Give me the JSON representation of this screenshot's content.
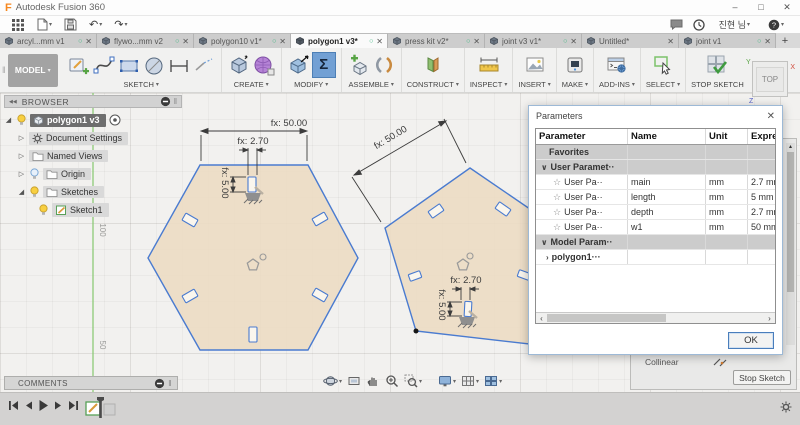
{
  "titlebar": {
    "app_title": "Autodesk Fusion 360"
  },
  "user": {
    "name": "진현 님"
  },
  "icons": {
    "dropdown": "▾",
    "minimize": "–",
    "maximize": "□",
    "window_close": "✕",
    "tab_status": "○",
    "tab_close": "✕",
    "new_tab": "+",
    "grip": "‖",
    "collapse_panel": "◀◀",
    "undo": "↶",
    "redo": "↷",
    "sigma": "Σ",
    "expand": "◢",
    "collapsed": "▷",
    "star": "☆",
    "chevron_down": "∨",
    "chevron_right": "›",
    "scroll_left": "‹",
    "scroll_right": "›",
    "scroll_up": "▴",
    "help": "?"
  },
  "tabs": {
    "items": [
      {
        "label": "arcyl...mm v1",
        "status": true,
        "active": false
      },
      {
        "label": "flywo...mm v2",
        "status": true,
        "active": false
      },
      {
        "label": "polygon10 v1*",
        "status": true,
        "active": false
      },
      {
        "label": "polygon1 v3*",
        "status": true,
        "active": true
      },
      {
        "label": "press kit v2*",
        "status": true,
        "active": false
      },
      {
        "label": "joint v3 v1*",
        "status": true,
        "active": false
      },
      {
        "label": "Untitled*",
        "status": false,
        "active": false
      },
      {
        "label": "joint v1",
        "status": true,
        "active": false
      }
    ],
    "new_tab": "+"
  },
  "toolbar": {
    "workspace": "MODEL",
    "groups": [
      "SKETCH",
      "CREATE",
      "MODIFY",
      "ASSEMBLE",
      "CONSTRUCT",
      "INSPECT",
      "INSERT",
      "MAKE",
      "ADD-INS",
      "SELECT"
    ],
    "stop_sketch": "STOP SKETCH"
  },
  "browser": {
    "header": "BROWSER",
    "items": [
      {
        "label": "polygon1 v3"
      },
      {
        "label": "Document Settings"
      },
      {
        "label": "Named Views"
      },
      {
        "label": "Origin"
      },
      {
        "label": "Sketches"
      },
      {
        "label": "Sketch1"
      }
    ]
  },
  "viewcube": {
    "face": "TOP",
    "axis_x": "X",
    "axis_y": "Y",
    "axis_z": "Z"
  },
  "canvas": {
    "axis_label_100": "100",
    "axis_label_50": "50",
    "hexagon": {
      "width_dim": "fx: 50.00",
      "slot_width_dim": "fx: 2.70",
      "slot_height_dim": "fx: 5.00"
    },
    "pentagon": {
      "edge_dim": "fx: 50.00",
      "slot_width_dim": "fx: 2.70",
      "slot_height_dim": "fx: 5.00"
    }
  },
  "parameters_dialog": {
    "title": "Parameters",
    "columns": [
      "Parameter",
      "Name",
      "Unit",
      "Expression"
    ],
    "rows": [
      {
        "parameter": "Favorites",
        "name": "",
        "unit": "",
        "expression": ""
      },
      {
        "parameter": "User Paramet··",
        "name": "",
        "unit": "",
        "expression": ""
      },
      {
        "parameter": "User Pa··",
        "name": "main",
        "unit": "mm",
        "expression": "2.7 mm"
      },
      {
        "parameter": "User Pa··",
        "name": "length",
        "unit": "mm",
        "expression": "5 mm"
      },
      {
        "parameter": "User Pa··",
        "name": "depth",
        "unit": "mm",
        "expression": "2.7 mm"
      },
      {
        "parameter": "User Pa··",
        "name": "w1",
        "unit": "mm",
        "expression": "50 mm"
      },
      {
        "parameter": "Model Param··",
        "name": "",
        "unit": "",
        "expression": ""
      },
      {
        "parameter": "polygon1···",
        "name": "",
        "unit": "",
        "expression": ""
      }
    ],
    "ok": "OK"
  },
  "sketch_palette": {
    "collinear": "Collinear",
    "stop_sketch": "Stop Sketch"
  },
  "comments": {
    "label": "COMMENTS"
  },
  "colors": {
    "sketch_profile_fill": "#ecdcc3",
    "sketch_line": "#4a7bd0",
    "selected_tool_bg": "#72a0d4",
    "axis_green": "#86c86e",
    "tab_status_green": "#35b57c"
  }
}
